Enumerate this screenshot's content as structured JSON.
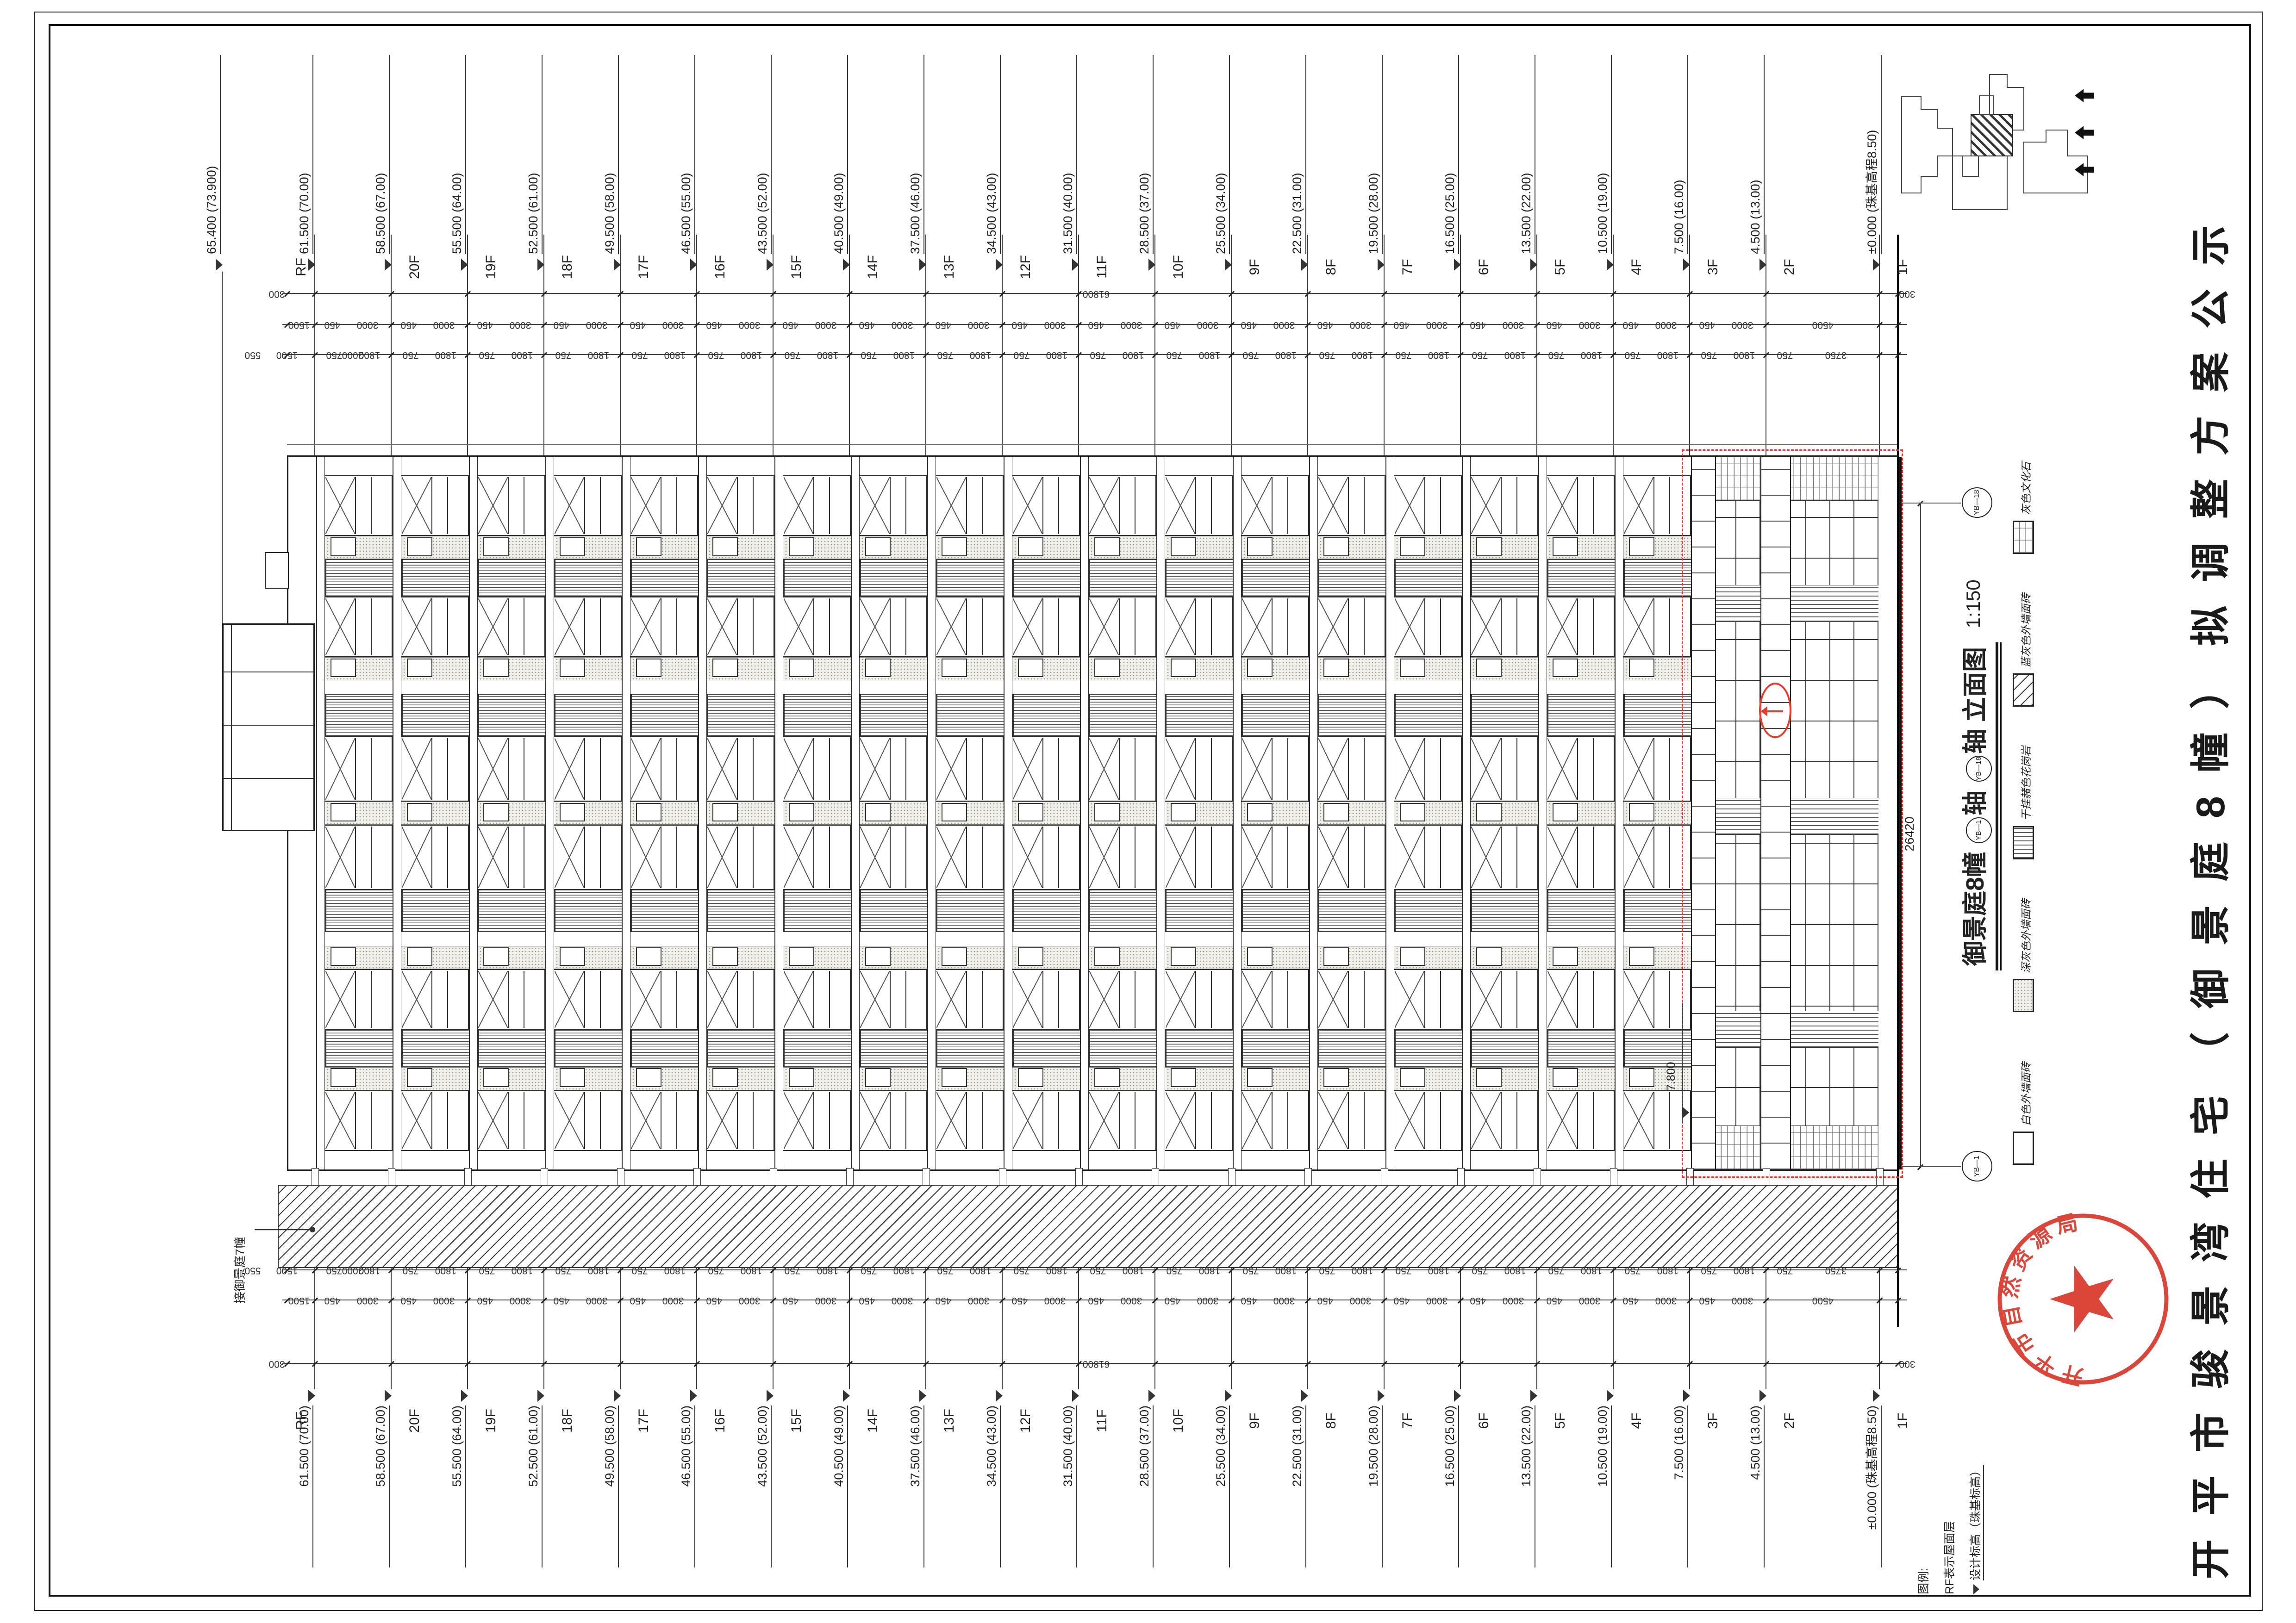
{
  "sheet": {
    "public_title": "开平市骏景湾住宅（御景庭8幢）拟调整方案公示"
  },
  "drawing_title": {
    "building": "御景庭8幢",
    "axis_start": "YB—1",
    "axis_word1": "轴",
    "axis_end": "YB—18",
    "axis_word2": "轴",
    "suffix": "立面图",
    "scale": "1:150"
  },
  "levels": [
    {
      "floor": "RF",
      "elevation": "61.500",
      "absolute": "(70.00)"
    },
    {
      "floor": "20F",
      "elevation": "58.500",
      "absolute": "(67.00)"
    },
    {
      "floor": "19F",
      "elevation": "55.500",
      "absolute": "(64.00)"
    },
    {
      "floor": "18F",
      "elevation": "52.500",
      "absolute": "(61.00)"
    },
    {
      "floor": "17F",
      "elevation": "49.500",
      "absolute": "(58.00)"
    },
    {
      "floor": "16F",
      "elevation": "46.500",
      "absolute": "(55.00)"
    },
    {
      "floor": "15F",
      "elevation": "43.500",
      "absolute": "(52.00)"
    },
    {
      "floor": "14F",
      "elevation": "40.500",
      "absolute": "(49.00)"
    },
    {
      "floor": "13F",
      "elevation": "37.500",
      "absolute": "(46.00)"
    },
    {
      "floor": "12F",
      "elevation": "34.500",
      "absolute": "(43.00)"
    },
    {
      "floor": "11F",
      "elevation": "31.500",
      "absolute": "(40.00)"
    },
    {
      "floor": "10F",
      "elevation": "28.500",
      "absolute": "(37.00)"
    },
    {
      "floor": "9F",
      "elevation": "25.500",
      "absolute": "(34.00)"
    },
    {
      "floor": "8F",
      "elevation": "22.500",
      "absolute": "(31.00)"
    },
    {
      "floor": "7F",
      "elevation": "19.500",
      "absolute": "(28.00)"
    },
    {
      "floor": "6F",
      "elevation": "16.500",
      "absolute": "(25.00)"
    },
    {
      "floor": "5F",
      "elevation": "13.500",
      "absolute": "(22.00)"
    },
    {
      "floor": "4F",
      "elevation": "10.500",
      "absolute": "(19.00)"
    },
    {
      "floor": "3F",
      "elevation": "7.500",
      "absolute": "(16.00)"
    },
    {
      "floor": "2F",
      "elevation": "4.500",
      "absolute": "(13.00)"
    },
    {
      "floor": "1F",
      "elevation": "±0.000",
      "absolute": "(珠基高程8.50)"
    }
  ],
  "machine_level": {
    "elevation": "65.400",
    "absolute": "(73.900)"
  },
  "dims": {
    "overall": "61800",
    "margin": "300",
    "parapet": "1500",
    "floor_upper": "450",
    "floor_main": "3000",
    "ground_floor": "4500",
    "fine_top": [
      "550",
      "1500",
      "2000"
    ],
    "fine_upper": "750",
    "fine_main": "1800",
    "fine_bottom": "3750",
    "podium_width": "26420",
    "podium_level": "7.800"
  },
  "axes": {
    "start": "YB—1",
    "end": "YB—18"
  },
  "annotations": {
    "adjacent_building": "接御景庭7幢"
  },
  "legend": {
    "items": [
      {
        "name": "white-tile",
        "label": "白色外墙面砖"
      },
      {
        "name": "dark-gray-tile",
        "label": "深灰色外墙面砖"
      },
      {
        "name": "granite-panel",
        "label": "干挂赭色花岗岩"
      },
      {
        "name": "blue-gray-tile",
        "label": "蓝灰色外墙面砖"
      },
      {
        "name": "culture-stone",
        "label": "灰色文化石"
      }
    ]
  },
  "notes": {
    "header": "图例:",
    "rf_note": "RF表示屋面层",
    "level_note": "设计标高（珠基标高）"
  },
  "stamp": {
    "agency": "开平市自然资源局"
  }
}
